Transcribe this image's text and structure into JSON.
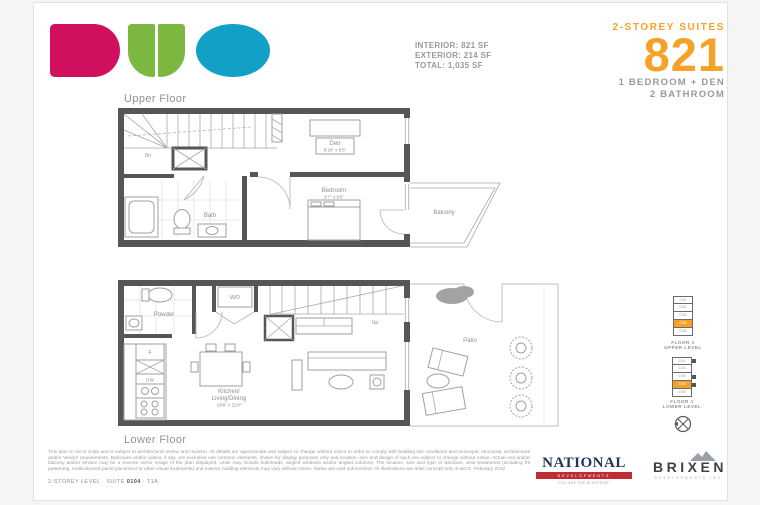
{
  "page": {
    "background": "#ffffff",
    "sheet_border": "#e2e2e2"
  },
  "brand": {
    "name": "DUO",
    "letters": [
      "D",
      "U",
      "O"
    ],
    "colors": {
      "d_pink": "#d0105f",
      "u_green": "#7cb83f",
      "o_teal": "#12a0c6"
    }
  },
  "header": {
    "stats": [
      "INTERIOR: 821 SF",
      "EXTERIOR: 214 SF",
      "TOTAL: 1,035 SF"
    ],
    "series_label": "2-STOREY SUITES",
    "suite_number": "821",
    "config_line1": "1 BEDROOM + DEN",
    "config_line2": "2 BATHROOM",
    "accent_color": "#f5a228",
    "text_color": "#97999b"
  },
  "upper_floor": {
    "title": "Upper Floor",
    "labels": {
      "den_name": "Den",
      "den_dims": "8'10\" x 8'5\"",
      "bedroom_name": "Bedroom",
      "bedroom_dims": "9'7\" x 9'6\"",
      "bath": "Bath",
      "balcony": "Balcony",
      "stairs": "Dn"
    }
  },
  "lower_floor": {
    "title": "Lower Floor",
    "labels": {
      "powder": "Powder",
      "washer_dryer": "W/D",
      "fridge": "F",
      "dishwasher": "DW",
      "kitchen_line1": "Kitchen/",
      "kitchen_line2": "Living/Dining",
      "kitchen_dims": "19'8\" x 11'8\"",
      "patio": "Patio",
      "stairs": "Up"
    }
  },
  "keyplan": {
    "upper_label_line1": "FLOOR 1",
    "upper_label_line2": "UPPER LEVEL",
    "lower_label_line1": "FLOOR 1",
    "lower_label_line2": "LOWER LEVEL",
    "units": [
      "0101",
      "0102",
      "0103",
      "0104",
      "0105"
    ],
    "highlighted_unit": "0104",
    "highlight_color": "#f5a228"
  },
  "icons": {
    "compass": "circle with cross and pointer",
    "mountain": "two gray peaks"
  },
  "footer": {
    "disclaimer": "This plan is not to scale and is subject to architectural review and revision. All details are approximate and subject to change without notice in order to comply with building site conditions and municipal, structural, architectural and/or Vendor requirements. Balconies and/or patios, if any, are exclusive use common elements, shown for display purposes only and location, size and design of such are subject to change without notice. Actual unit and/or balcony and/or terrace may be a reverse mirror image of the plan displayed. Units may include bulkheads, angled windows and/or angled columns. The location, size and type of windows, view treatments (including frit patterning, multicoloured panel placement or other visual treatments) and exterior building elements may vary without notice. Suites are sold unfurnished. All illustrations are artist concept only. E.&O.E. February 2022",
    "suite_line_prefix": "2-STOREY LEVEL · SUITE ",
    "suite_line_bold": "0104",
    "suite_line_suffix": " · T1A"
  },
  "logos": {
    "national": {
      "name": "NATIONAL",
      "band": "DEVELOPMENTS",
      "tagline": "“YOU ARE THE BLUEPRINT”",
      "navy": "#23355c",
      "red": "#bf2c35"
    },
    "brixen": {
      "name": "BRIXEN",
      "sub": "DEVELOPMENTS INC.",
      "color": "#3c4148"
    }
  }
}
